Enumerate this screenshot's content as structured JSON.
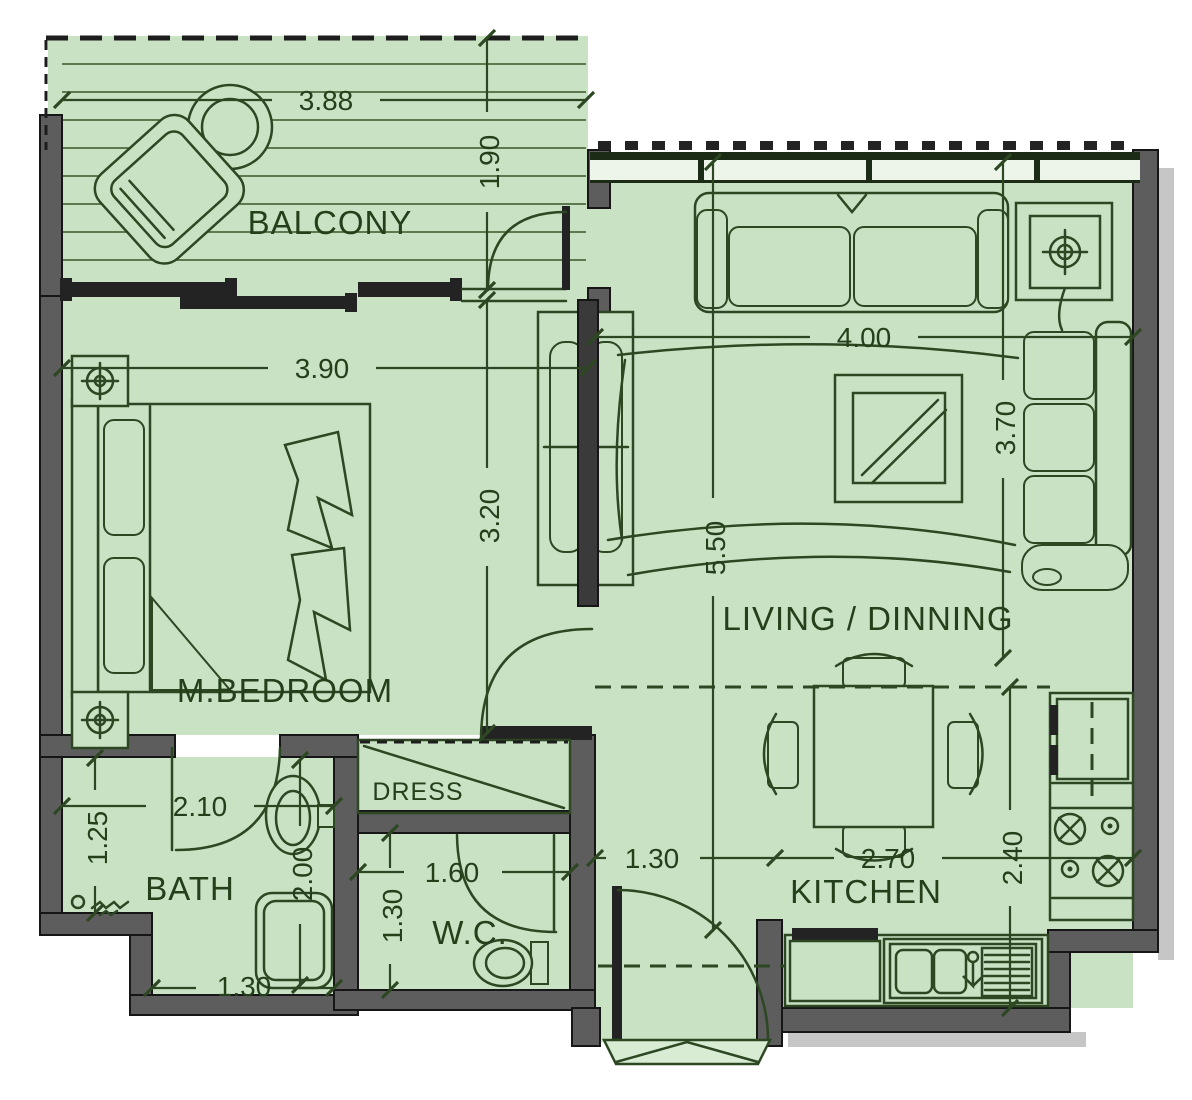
{
  "plan": {
    "rooms": {
      "balcony": "BALCONY",
      "bedroom": "M.BEDROOM",
      "living": "LIVING / DINNING",
      "bath": "BATH",
      "wc": "W.C.",
      "kitchen": "KITCHEN",
      "dress": "DRESS"
    },
    "dimensions": {
      "balcony_width": "3.88",
      "balcony_depth": "1.90",
      "bedroom_width": "3.90",
      "bedroom_depth": "3.20",
      "living_length": "5.50",
      "living_width": "4.00",
      "living_depth": "3.70",
      "bath_width": "2.10",
      "bath_side": "1.25",
      "bath_length": "2.00",
      "bath_lower_width": "1.30",
      "wc_width": "1.60",
      "wc_depth": "1.30",
      "hall_width": "1.30",
      "kitchen_width": "2.70",
      "kitchen_depth": "2.40"
    },
    "colors": {
      "floor_green": "#c9e2c4",
      "wall_gray": "#5d5d5d",
      "line_dark_green": "#2c4722",
      "text_dark_green": "#24401b",
      "window_band": "#edf5ea"
    },
    "furniture_icons": [
      "round-table",
      "lounge-chair",
      "double-bed",
      "nightstand-lamp",
      "wardrobe",
      "sofa",
      "corner-sofa",
      "side-table",
      "coffee-table",
      "rug",
      "dining-table",
      "dining-chair",
      "washbasin",
      "bathtub",
      "floor-drain",
      "toilet",
      "fridge",
      "stove-burners",
      "kitchen-sink",
      "kitchen-counter",
      "entrance-door"
    ]
  }
}
